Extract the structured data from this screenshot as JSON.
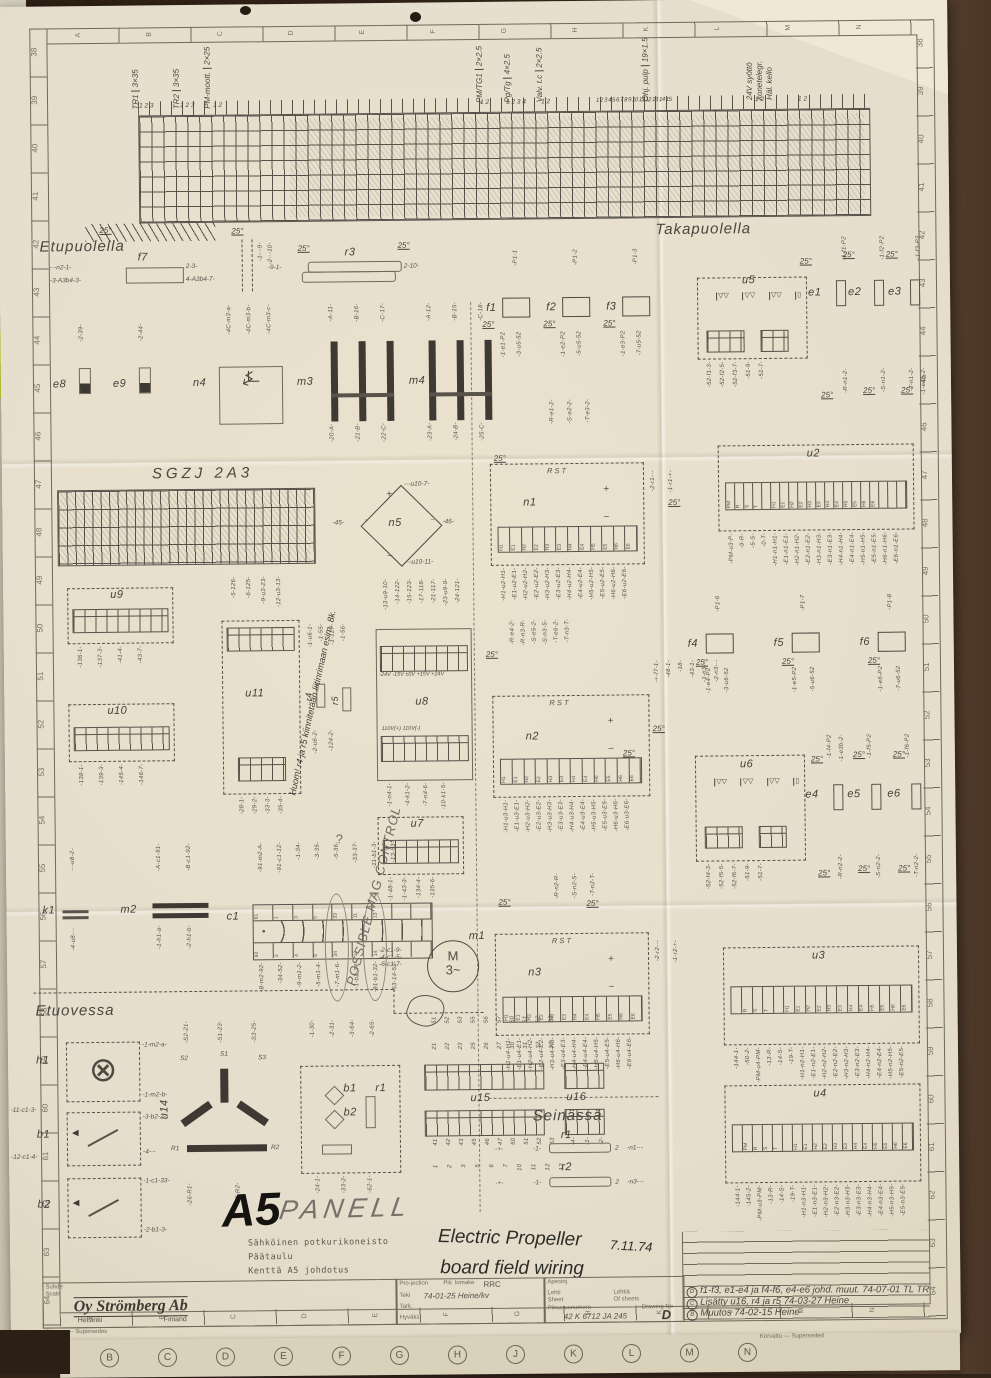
{
  "sheet": {
    "deg": "25°",
    "sections": {
      "etupuolella": "Etupuolella",
      "takapuolella": "Takapuolella",
      "etuovessa": "Etuovessa",
      "seinassa": "Seinässä",
      "sgzj": "SGZJ  2A3"
    }
  },
  "border": {
    "left_numbers": [
      "38",
      "39",
      "40",
      "41",
      "42",
      "43",
      "44",
      "45",
      "46",
      "47",
      "48",
      "49",
      "50",
      "51",
      "52",
      "53",
      "54",
      "55",
      "56",
      "57",
      "58",
      "59",
      "60",
      "61",
      "62",
      "63",
      "64"
    ],
    "right_numbers": [
      "38",
      "39",
      "40",
      "41",
      "42",
      "43",
      "44",
      "45",
      "46",
      "47",
      "48",
      "49",
      "50",
      "51",
      "52",
      "53",
      "54",
      "55",
      "56",
      "57",
      "58",
      "59",
      "60",
      "61",
      "62",
      "63",
      "64"
    ],
    "top_letters": [
      "A",
      "B",
      "C",
      "D",
      "E",
      "F",
      "G",
      "H",
      "K",
      "L",
      "M",
      "N"
    ],
    "bottom_letters": [
      "A",
      "B",
      "C",
      "D",
      "E",
      "F",
      "G",
      "H",
      "K",
      "L",
      "M",
      "N"
    ],
    "korvaa": "Korvaa — Supersedes",
    "korvattu": "Korvattu — Superseded",
    "under_letters": [
      "B",
      "C",
      "D",
      "E",
      "F",
      "G",
      "H",
      "J",
      "K",
      "L",
      "M",
      "N"
    ]
  },
  "cables": {
    "tr1": {
      "name": "TR1",
      "size": "3×35",
      "pins": "1 2 3"
    },
    "tr2": {
      "name": "TR2",
      "size": "3×35",
      "pins": "1 2 3"
    },
    "pmm": {
      "name": "PM-moott.",
      "size": "2×25",
      "pins": "1 2"
    },
    "pmtg": {
      "name": "PM/TG1",
      "size": "2×2.5",
      "pins": "1 2"
    },
    "pgtg": {
      "name": "Pg/Tg",
      "size": "4×2.5",
      "pins": "1 2 3 4"
    },
    "valv": {
      "name": "Valv. t.c",
      "size": "2×2.5",
      "pins": "1 2"
    },
    "ohj": {
      "name": "Ohj. pulp",
      "size": "19×1.5",
      "pins": "1 2 3 4 5 6 7 8 9 10 11 12 13 14 15"
    },
    "v24": {
      "name": "24V syöttö",
      "l2": "konetelegr.",
      "l3": "Häl. kello",
      "pins": "1 2",
      "pins2": "1 2"
    }
  },
  "components": {
    "f7": {
      "label": "f7",
      "wl": [
        "-·-n2-1-",
        "-3-A3b4-3-"
      ],
      "wr": [
        "2-3-",
        "4-A3b4-7-"
      ],
      "wv": [
        "-1-·-9-",
        "-2-·-10-"
      ]
    },
    "r3": {
      "label": "r3",
      "wl": "-9-1-",
      "wr": "2-10-"
    },
    "e8": {
      "label": "e8",
      "wt": "-2-39-"
    },
    "e9": {
      "label": "e9",
      "wt": "-2-44-"
    },
    "n4": {
      "label": "n4",
      "wt": [
        "-4C-m3-a-",
        "-4C-m3-b-",
        "-4C-m3-c-"
      ]
    },
    "m3": {
      "label": "m3",
      "wt": [
        "-A-11-",
        "-B-16-",
        "-C-17-"
      ],
      "wb": [
        "-20-A-",
        "-21-B-",
        "-22-C-"
      ]
    },
    "m4": {
      "label": "m4",
      "wt": [
        "-A-12-",
        "-B-15-",
        "-C-18-"
      ],
      "wb": [
        "-23-A-",
        "-24-B-",
        "-25-C-"
      ]
    },
    "f1": {
      "label": "f1",
      "wt": "-P1-1",
      "wb": [
        "-1-e1-P2",
        "-3-u5-52"
      ]
    },
    "f2": {
      "label": "f2",
      "wt": "-P1-2",
      "wb": [
        "-1-e2-P2",
        "-5-u5-52"
      ]
    },
    "f3": {
      "label": "f3",
      "wt": "-P1-3",
      "wb": [
        "-1-e3-P2",
        "-7-u5-52"
      ]
    },
    "u5": {
      "label": "u5",
      "wb": [
        "-52-f1-3-",
        "-52-f2-5-",
        "-52-f3-7-",
        "-51-9-",
        "-51-7-"
      ]
    },
    "e1": {
      "label": "e1",
      "wt": "-1-f1-P2",
      "wm": "-1-59-",
      "wb": "-R-n1-2-"
    },
    "e2": {
      "label": "e2",
      "wt": "-1-f2-P2",
      "wm": "-1-52-",
      "wb": "-S-n1-2-"
    },
    "e3": {
      "label": "e3",
      "wt": "-1-f3-P2",
      "wb": [
        "-T-n1-2-",
        "-1-e4b-2-"
      ]
    },
    "ncells": [
      "H1",
      "E1",
      "H2",
      "E2",
      "H3",
      "E3",
      "H4",
      "E4",
      "H5",
      "E5",
      "H6",
      "E6"
    ],
    "n1": {
      "label": "n1",
      "rst": "R  S  T",
      "rstw": [
        "-R-e1-2-",
        "-S-e2-2-",
        "-T-e3-2-"
      ],
      "plus": "+",
      "minus": "−",
      "wb": [
        "-H1-u2-H1-",
        "-E1-u2-E1-",
        "-H2-u2-H2-",
        "-E2-u2-E2-",
        "-H3-u2-H3-",
        "-E3-u2-E3-",
        "-H4-u2-H4-",
        "-E4-u2-E4-",
        "-H5-u2-H5-",
        "-E5-u2-E5-",
        "-H6-u2-H6-",
        "-E6-u2-E6-"
      ],
      "wr": [
        "-2-r1-·-",
        "-1-r1-+-"
      ]
    },
    "u2": {
      "label": "u2",
      "cells": [
        "PM",
        "R",
        "S",
        "T",
        "",
        "H1",
        "E1",
        "H2",
        "E2",
        "H3",
        "E3",
        "H4",
        "E4",
        "H5",
        "E5",
        "H6",
        "E6",
        "",
        "",
        ""
      ],
      "wb": [
        "-PM-u3-P-",
        "-9-R-",
        "-5-S-",
        "-0-T-",
        "-H1-n1-H1-",
        "-E1-n1-E1-",
        "-H2-n1-H2-",
        "-E2-n1-E2-",
        "-H3-n1-H3-",
        "-E3-n1-E3-",
        "-H4-n1-H4-",
        "-E4-n1-E4-",
        "-H5-n1-H5-",
        "-E5-n1-E5-",
        "-H6-n1-H6-",
        "-E6-n1-E6-"
      ]
    },
    "n5": {
      "label": "n5",
      "wl": "-45-",
      "wr": "-46-",
      "wt": "-·-u10-7-",
      "wb": "-·-u10-11-",
      "plus": "+",
      "minus": "−",
      "ac": "~"
    },
    "u9": {
      "label": "u9",
      "wb": [
        "-136-1-",
        "-137-3-",
        "-41-4-",
        "-43-7-"
      ]
    },
    "u10": {
      "label": "u10",
      "wb": [
        "-138-1-",
        "-139-3-",
        "-145-4-",
        "-146-7-"
      ]
    },
    "u11": {
      "label": "u11",
      "wt": [
        "-5-126-",
        "-6-125-",
        "-9-u3-23-",
        "-12-u3-13-"
      ],
      "wb": [
        "-28-1-",
        "-29-2-",
        "-33-3-",
        "-35-4-"
      ]
    },
    "r45": {
      "l1": "r4",
      "l2": "r5",
      "wt": [
        "-1-u6-1-",
        "-1-55-",
        "-1-127-",
        "-1-56-"
      ],
      "wb": [
        "-2-u6-2-",
        "-124-2-"
      ]
    },
    "u8": {
      "label": "u8",
      "wt": [
        "-13-u9-10-",
        "-14-122-",
        "-15-123-",
        "-17-118-",
        "-21-117-",
        "-23-u9-9-",
        "-24-121-"
      ],
      "volt": "-24V  -15V  ±0V  +15V  +24V",
      "v110": "110V(+)   110V(-)",
      "wb": [
        "-1-n4-1-",
        "-4-k1-2-",
        "-7-n4-6-",
        "-10-k1-5-"
      ]
    },
    "n2": {
      "label": "n2",
      "rst": "R  S  T",
      "rstw": [
        "-R-e4-2-",
        "-R-n3-R-",
        "-S-e5-2-",
        "-S-n3-S-",
        "-T-e6-2-",
        "-T-n3-T-"
      ],
      "plus": "+",
      "minus": "−",
      "wb": [
        "-H1-u3-H1-",
        "-E1-u3-E1-",
        "-H2-u3-H2-",
        "-E2-u3-E2-",
        "-H3-u3-H3-",
        "-E3-u3-E3-",
        "-H4-u3-H4-",
        "-E4-u3-E4-",
        "-H5-u3-H5-",
        "-E5-u3-E5-",
        "-H6-u3-H6-",
        "-E6-u3-E6-"
      ],
      "wr": [
        "-+-f7-1-",
        "-48-1-",
        "-18-",
        "-43-1-",
        "-1-n3-·-",
        "-2-n3-·-"
      ]
    },
    "f4": {
      "label": "f4",
      "wt": "-P1-6",
      "wb": [
        "-1-e4-P2",
        "-3-u6-52"
      ]
    },
    "f5": {
      "label": "f5",
      "wt": "-P1-7",
      "wb": [
        "-1-e5-P2",
        "-5-u6-52"
      ]
    },
    "f6": {
      "label": "f6",
      "wt": "-P1-8",
      "wb": [
        "-1-e6-P2",
        "-7-u6-52"
      ]
    },
    "u6": {
      "label": "u6",
      "wb": [
        "-52-f4-3-",
        "-52-f5-5-",
        "-52-f6-7-",
        "-51-9-",
        "-51-7-"
      ]
    },
    "e4": {
      "label": "e4",
      "wt": [
        "-1-f4-P2",
        "-1-e3b-2-"
      ],
      "wb": "-R-n2-2-"
    },
    "e5": {
      "label": "e5",
      "wt": [
        "-1-f5-P2"
      ],
      "wb": "-S-n2-2-"
    },
    "e6": {
      "label": "e6",
      "wt": [
        "-1-f6-P2"
      ],
      "wb": "-T-n2-2-"
    },
    "u7": {
      "label": "u7",
      "wb": [
        "-1-48-1-",
        "-1-43-3-",
        "-134-4-",
        "-135-6-"
      ]
    },
    "k1": {
      "label": "k1",
      "wt": "-·-u8-2-",
      "wb": "-4-u8-·-"
    },
    "m2": {
      "label": "m2",
      "wt": [
        "-A-c1-91-",
        "-B-c1-92-"
      ],
      "wb": [
        "-1-h1-a-",
        "-2-h1-b-"
      ]
    },
    "c1": {
      "label": "c1",
      "top": [
        "91",
        "1",
        "3",
        "5",
        "33",
        "11",
        "13",
        "",
        ""
      ],
      "bottom": [
        "92",
        "2",
        "4",
        "6",
        "34",
        "12",
        "14",
        "",
        ""
      ],
      "wt": [
        "-91-m2-A-",
        "-91-c1-12-",
        "-1-34-",
        "-3-35-",
        "-5-36-",
        "-33-37-",
        "-11-b1-3-",
        "-13-53-"
      ],
      "wb": [
        "-B-m2-92-",
        "-34-52-",
        "-9-m1-2-",
        "-5-m1-4-",
        "-7-m1-6-",
        "-1-b2-34-",
        "-91-b1-32-",
        "-53-14-52-"
      ]
    },
    "m1": {
      "label": "m1",
      "sym": "M",
      "ph": "3~",
      "wl": [
        "-2-c1-9-",
        "-4-c1-5-",
        "-6-c1-7-"
      ]
    },
    "n3": {
      "label": "n3",
      "rst": "R  S  T",
      "rstw": [
        "-R-n2-R-",
        "-S-n2-S-",
        "-T-n2-T-"
      ],
      "plus": "+",
      "minus": "−",
      "wb": [
        "-H1-u4-H1-",
        "-E1-u4-E1-",
        "-H2-u4-H2-",
        "-E2-u4-E2-",
        "-H3-u4-H3-",
        "-E3-u4-E3-",
        "-H4-u4-H4-",
        "-E4-u4-E4-",
        "-H5-u4-H5-",
        "-E5-u4-E5-",
        "-H6-u4-H6-",
        "-E6-u4-E6-"
      ],
      "wr": [
        "-2-r2-·-",
        "-1-r2-+-"
      ]
    },
    "u3": {
      "label": "u3",
      "cells": [
        "",
        "R",
        "S",
        "T",
        "",
        "H1",
        "E1",
        "H2",
        "E2",
        "H3",
        "E3",
        "H4",
        "E4",
        "H5",
        "E5",
        "H6",
        "E6"
      ],
      "wb": [
        "-144-1-",
        "-50-2-",
        "-PM-u4-PM-",
        "-13-R-",
        "-14-S-",
        "-19-T-",
        "-H1-n2-H1-",
        "-E1-n2-E1-",
        "-H2-n2-H2-",
        "-E2-n2-E2-",
        "-H3-n2-H3-",
        "-E3-n2-E3-",
        "-H4-n2-H4-",
        "-E4-n2-E4-",
        "-H5-n2-H5-",
        "-E5-n2-E5-"
      ]
    },
    "u4": {
      "label": "u4",
      "cells": [
        "",
        "PM",
        "R",
        "S",
        "T",
        "",
        "H1",
        "E1",
        "H2",
        "E2",
        "H3",
        "E3",
        "H4",
        "E4",
        "H5",
        "E5",
        "H6",
        "E6"
      ],
      "wb": [
        "-144-1-",
        "-145-2-",
        "-PM-u3-PM-",
        "-13-R-",
        "-14-S-",
        "-19-T-",
        "-H1-n3-H1-",
        "-E1-n3-E1-",
        "-H2-n3-H2-",
        "-E2-n3-E2-",
        "-H3-n3-H3-",
        "-E3-n3-E3-",
        "-H4-n3-H4-",
        "-E4-n3-E4-",
        "-H5-n3-H5-",
        "-E5-n3-E5-"
      ]
    },
    "h1": {
      "label": "h1",
      "wt": "-1-m2-a-",
      "wb": "-1-m2-b-"
    },
    "b1": {
      "label": "b1",
      "wlf": [
        "-11-c1-3-",
        "-12-c1-4-"
      ],
      "wr": [
        "-3-b2-2-",
        "-4-·-"
      ]
    },
    "b2": {
      "label": "b2",
      "wr": [
        "-1-c1-33-",
        "-2-b1-3-"
      ]
    },
    "u14": {
      "label": "u14",
      "s1": "S1",
      "s2": "S2",
      "s3": "S3",
      "r1": "R1",
      "r2": "R2",
      "wt": [
        "-S2-21-",
        "-S1-23-",
        "-S3-25-"
      ],
      "wb": [
        "-26-R1-",
        "-27-R2-"
      ]
    },
    "mini": {
      "b1": "b1",
      "b2": "b2",
      "r1": "r1",
      "wt": [
        "-1-30-",
        "-2-31-",
        "-3-64-",
        "-2-65-"
      ],
      "wb": [
        "-24-1-",
        "-33-2-",
        "-62-1-"
      ]
    },
    "u15": {
      "label": "u15",
      "wt1": [
        "21",
        "22",
        "23",
        "25",
        "26",
        "27",
        "30",
        "31",
        "32",
        "33"
      ],
      "wt2": [
        "51",
        "52",
        "53",
        "55",
        "56",
        "57",
        "60",
        "61",
        "62",
        "63"
      ],
      "wb1": [
        "41",
        "42",
        "43",
        "45",
        "46",
        "47",
        "50",
        "51",
        "52",
        "53"
      ],
      "wb2": [
        "1",
        "2",
        "3",
        "5",
        "6",
        "7",
        "10",
        "11",
        "12",
        "13"
      ]
    },
    "u16": {
      "label": "u16",
      "wb": [
        "-4-",
        "-1-",
        "-2-"
      ]
    },
    "r1": {
      "label": "r1",
      "pre": "-+-",
      "a": "-1-",
      "b": "2",
      "post": "-n1-·-"
    },
    "r2": {
      "label": "r2",
      "pre": "-+-",
      "a": "-1-",
      "b": "2",
      "post": "-n3-·-"
    }
  },
  "handwriting": {
    "a5": "A5",
    "panel": "PANELL",
    "mag": "POSSIBLE MAG CONTROL",
    "q": "?",
    "huom": "Huom! r4 ja r5 kiinnitetään liitinrimaan esim. 8k.",
    "title1": "Electric Propeller",
    "date": "7.11.74",
    "title2": "board field wiring",
    "sticky": "3c"
  },
  "titleblock": {
    "typed1": "Sähköinen potkurikoneisto",
    "typed2": "Päätaulu",
    "typed3": "Kenttä A5 johdotus",
    "suhde": "Suhde",
    "scale": "Scale",
    "logo": "Oy Strömberg Ab",
    "city": "Helsinki",
    "country": "Finland",
    "projection": "Pro-jection",
    "piirlomake": "Piir. lomake",
    "rrc": "RRC",
    "apesinj": "Apesinj",
    "teki": "Teki",
    "teki_val": "74-01-25  Heine/kv",
    "tark": "Tark.",
    "hyvaks": "Hyväks.",
    "lehti": "Lehti",
    "sheet": "Sheet",
    "lehtia": "Lehtiä",
    "ofsheets": "Of sheets",
    "piirustusnumero": "Piirustusnumero",
    "drawingno": "Drawing No",
    "number": "42 K 6712 JA 245",
    "rev": "D"
  },
  "revisions": [
    {
      "mark": "D",
      "text": "f1-f3, e1-e4 ja f4-f6, e4-e6  johd. muut.   74-07-01  TL TR"
    },
    {
      "mark": "C",
      "text": "Lisätty u16, r4 ja r5    74-03-27   Heine"
    },
    {
      "mark": "B",
      "text": "Muutos  74-02-15  Heine"
    }
  ]
}
